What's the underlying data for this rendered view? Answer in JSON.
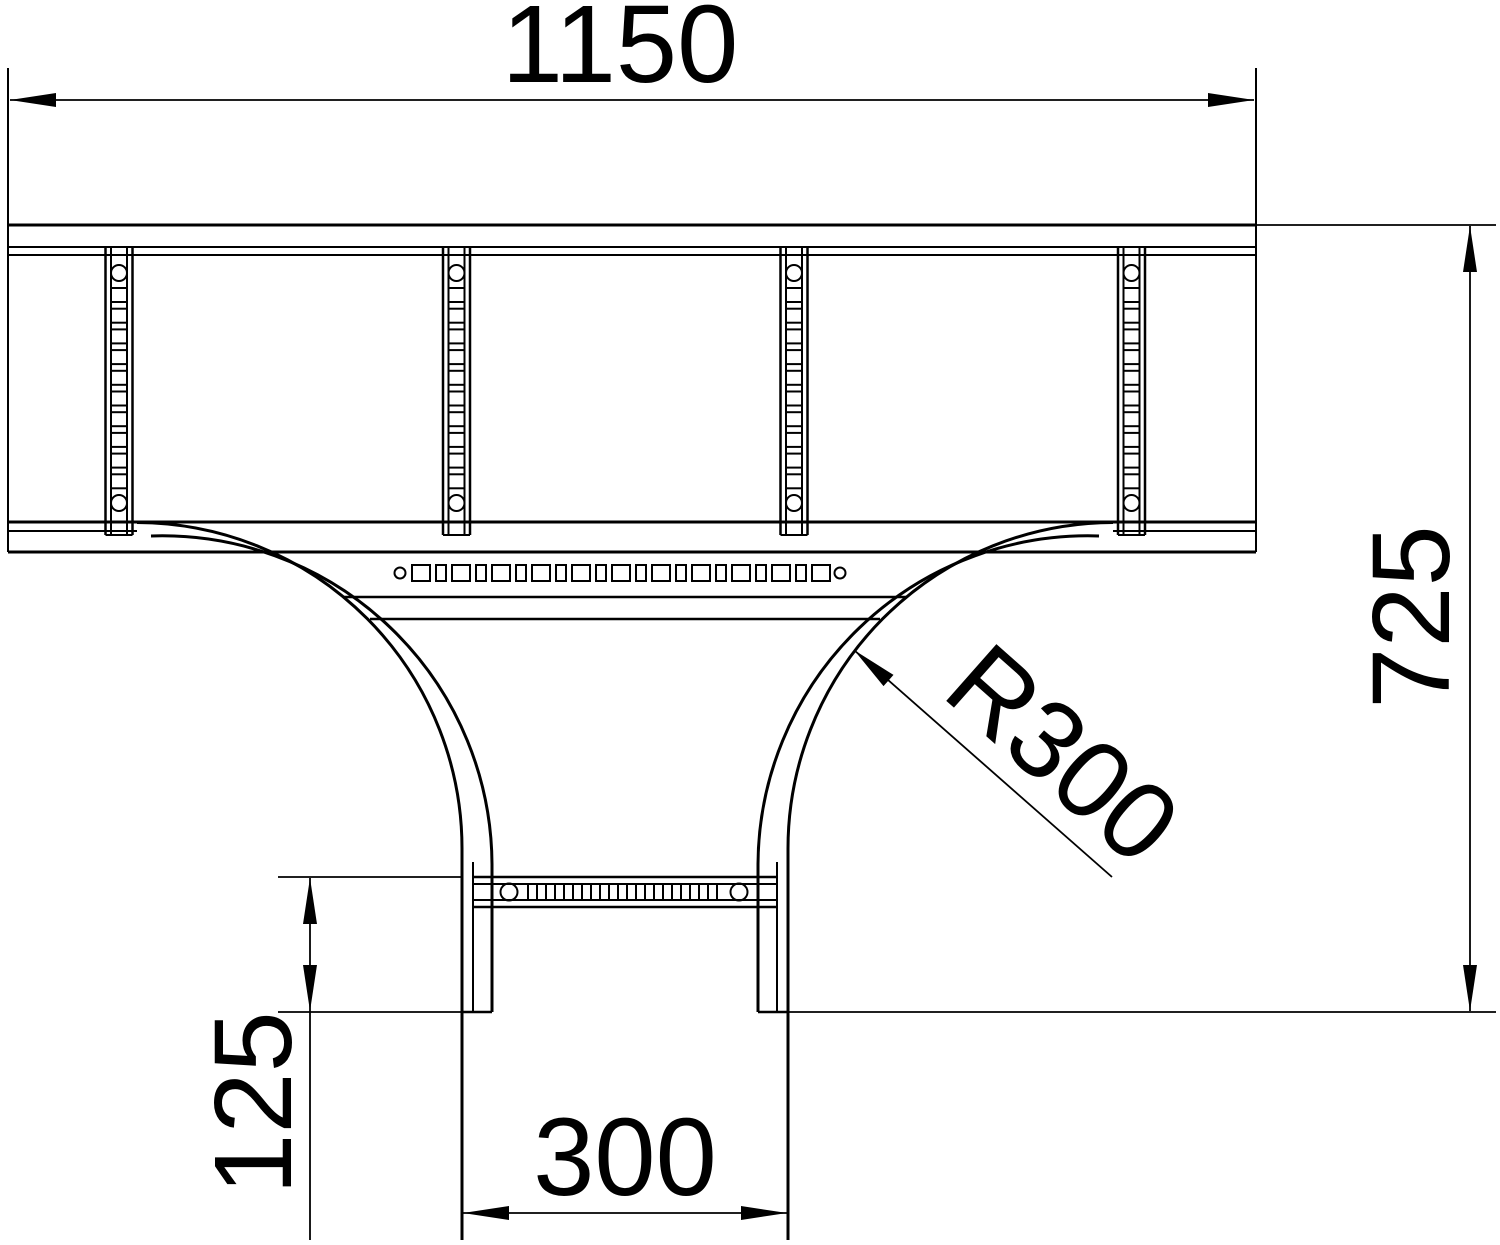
{
  "meta": {
    "title": "Cable ladder T-piece plan view technical drawing",
    "background_color": "#ffffff",
    "line_color": "#000000"
  },
  "dimensions": {
    "top_width": {
      "label": "1150"
    },
    "right_height": {
      "label": "725"
    },
    "fillet_radius": {
      "label": "R300"
    },
    "branch_offset": {
      "label": "125"
    },
    "branch_width": {
      "label": "300"
    }
  }
}
